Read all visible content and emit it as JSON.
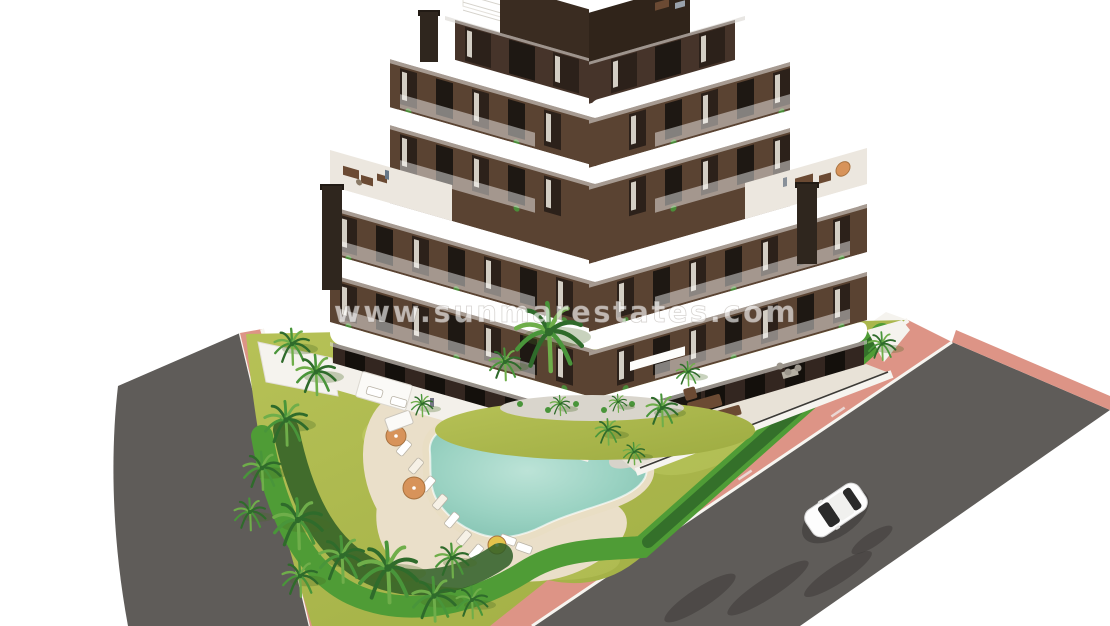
{
  "watermark": {
    "text": "www.sunmarestates.com"
  },
  "scene": {
    "type": "aerial-3d-architectural-render",
    "subject": "new-build-apartment-complex-with-communal-pool-and-garden",
    "elements": [
      "apartment-building",
      "white-wavy-balcony-bands",
      "brown-facade",
      "roof-terraces",
      "penthouse",
      "chimneys",
      "ground-floor-terraces",
      "communal-tiled-terrace",
      "swimming-pool",
      "pool-sand-deck",
      "sun-loungers",
      "orange-parasols",
      "yellow-parasol",
      "palm-trees",
      "lawn",
      "bright-hedge",
      "gravel-beds",
      "perimeter-white-wall",
      "pink-sidewalk",
      "asphalt-road-left",
      "asphalt-road-right",
      "lane-markings",
      "white-car",
      "tree-shadows"
    ]
  },
  "colors": {
    "background": "#ffffff",
    "facade_brown": "#5a4332",
    "facade_dark": "#46342a",
    "facade_darker": "#332620",
    "window_glass": "#1e1813",
    "window_glass_alt": "#2c211a",
    "curtain": "#f1ece3",
    "slab_white": "#ffffff",
    "slab_shadow": "#d9d6d0",
    "deck": "#ece7df",
    "terrace_tile": "#e8e2d7",
    "wall_white": "#f5f3ee",
    "lawn": "#aab648",
    "lawn_light": "#c6d06a",
    "hedge": "#4f9c36",
    "hedge_dark": "#34702a",
    "palm_bed": "#2e5e26",
    "palm_dark": "#2f6b2b",
    "palm_mid": "#49953a",
    "palm_light": "#6fae4a",
    "pool_water": "#8ec9ba",
    "pool_water_light": "#bce3d7",
    "sand": "#e9dec4",
    "deck_sand": "#eadfc9",
    "gravel": "#d7d3ca",
    "asphalt": "#5f5c59",
    "asphalt_dark": "#3e3b39",
    "sidewalk": "#dd9486",
    "curb": "#f7f5f0",
    "car_body": "#fdfdfd",
    "car_glass": "#2a2a2a",
    "parasol_orange": "#d7935a",
    "parasol_yellow": "#e3c34b",
    "furniture_brown": "#6b4a33"
  }
}
